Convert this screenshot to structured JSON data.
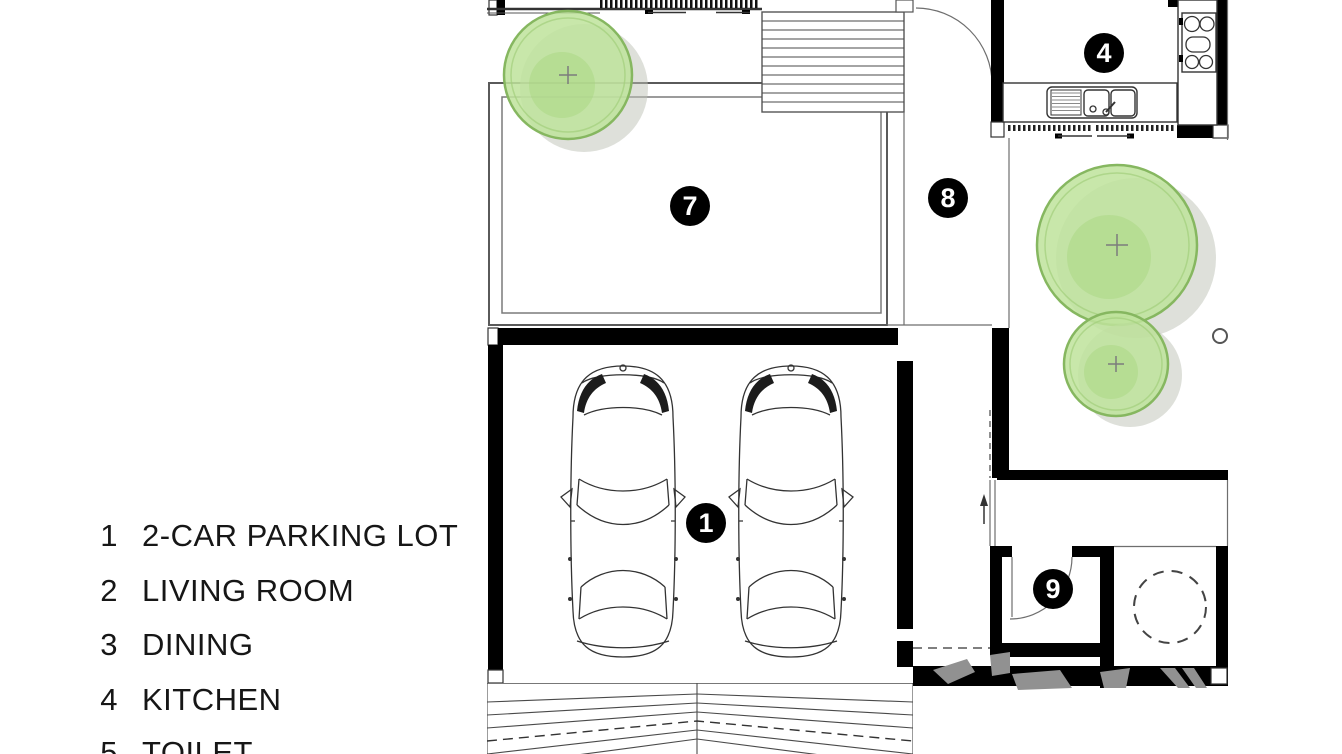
{
  "legend": {
    "items": [
      {
        "num": "1",
        "label": "2-CAR PARKING LOT"
      },
      {
        "num": "2",
        "label": "LIVING ROOM"
      },
      {
        "num": "3",
        "label": "DINING"
      },
      {
        "num": "4",
        "label": "KITCHEN"
      },
      {
        "num": "5",
        "label": "TOILET"
      }
    ]
  },
  "plan": {
    "badges": [
      {
        "id": "parking",
        "label": "1"
      },
      {
        "id": "kitchen",
        "label": "4"
      },
      {
        "id": "pool-terrace",
        "label": "7"
      },
      {
        "id": "side-yard",
        "label": "8"
      },
      {
        "id": "toilet",
        "label": "9"
      }
    ],
    "colors": {
      "wall": "#000000",
      "line": "#555555",
      "tree_fill": "#bee39b",
      "tree_rim": "#86b760",
      "shadow": "#bdc1b6",
      "badge_bg": "#000000",
      "badge_text": "#ffffff",
      "watermark": "#919191"
    }
  }
}
